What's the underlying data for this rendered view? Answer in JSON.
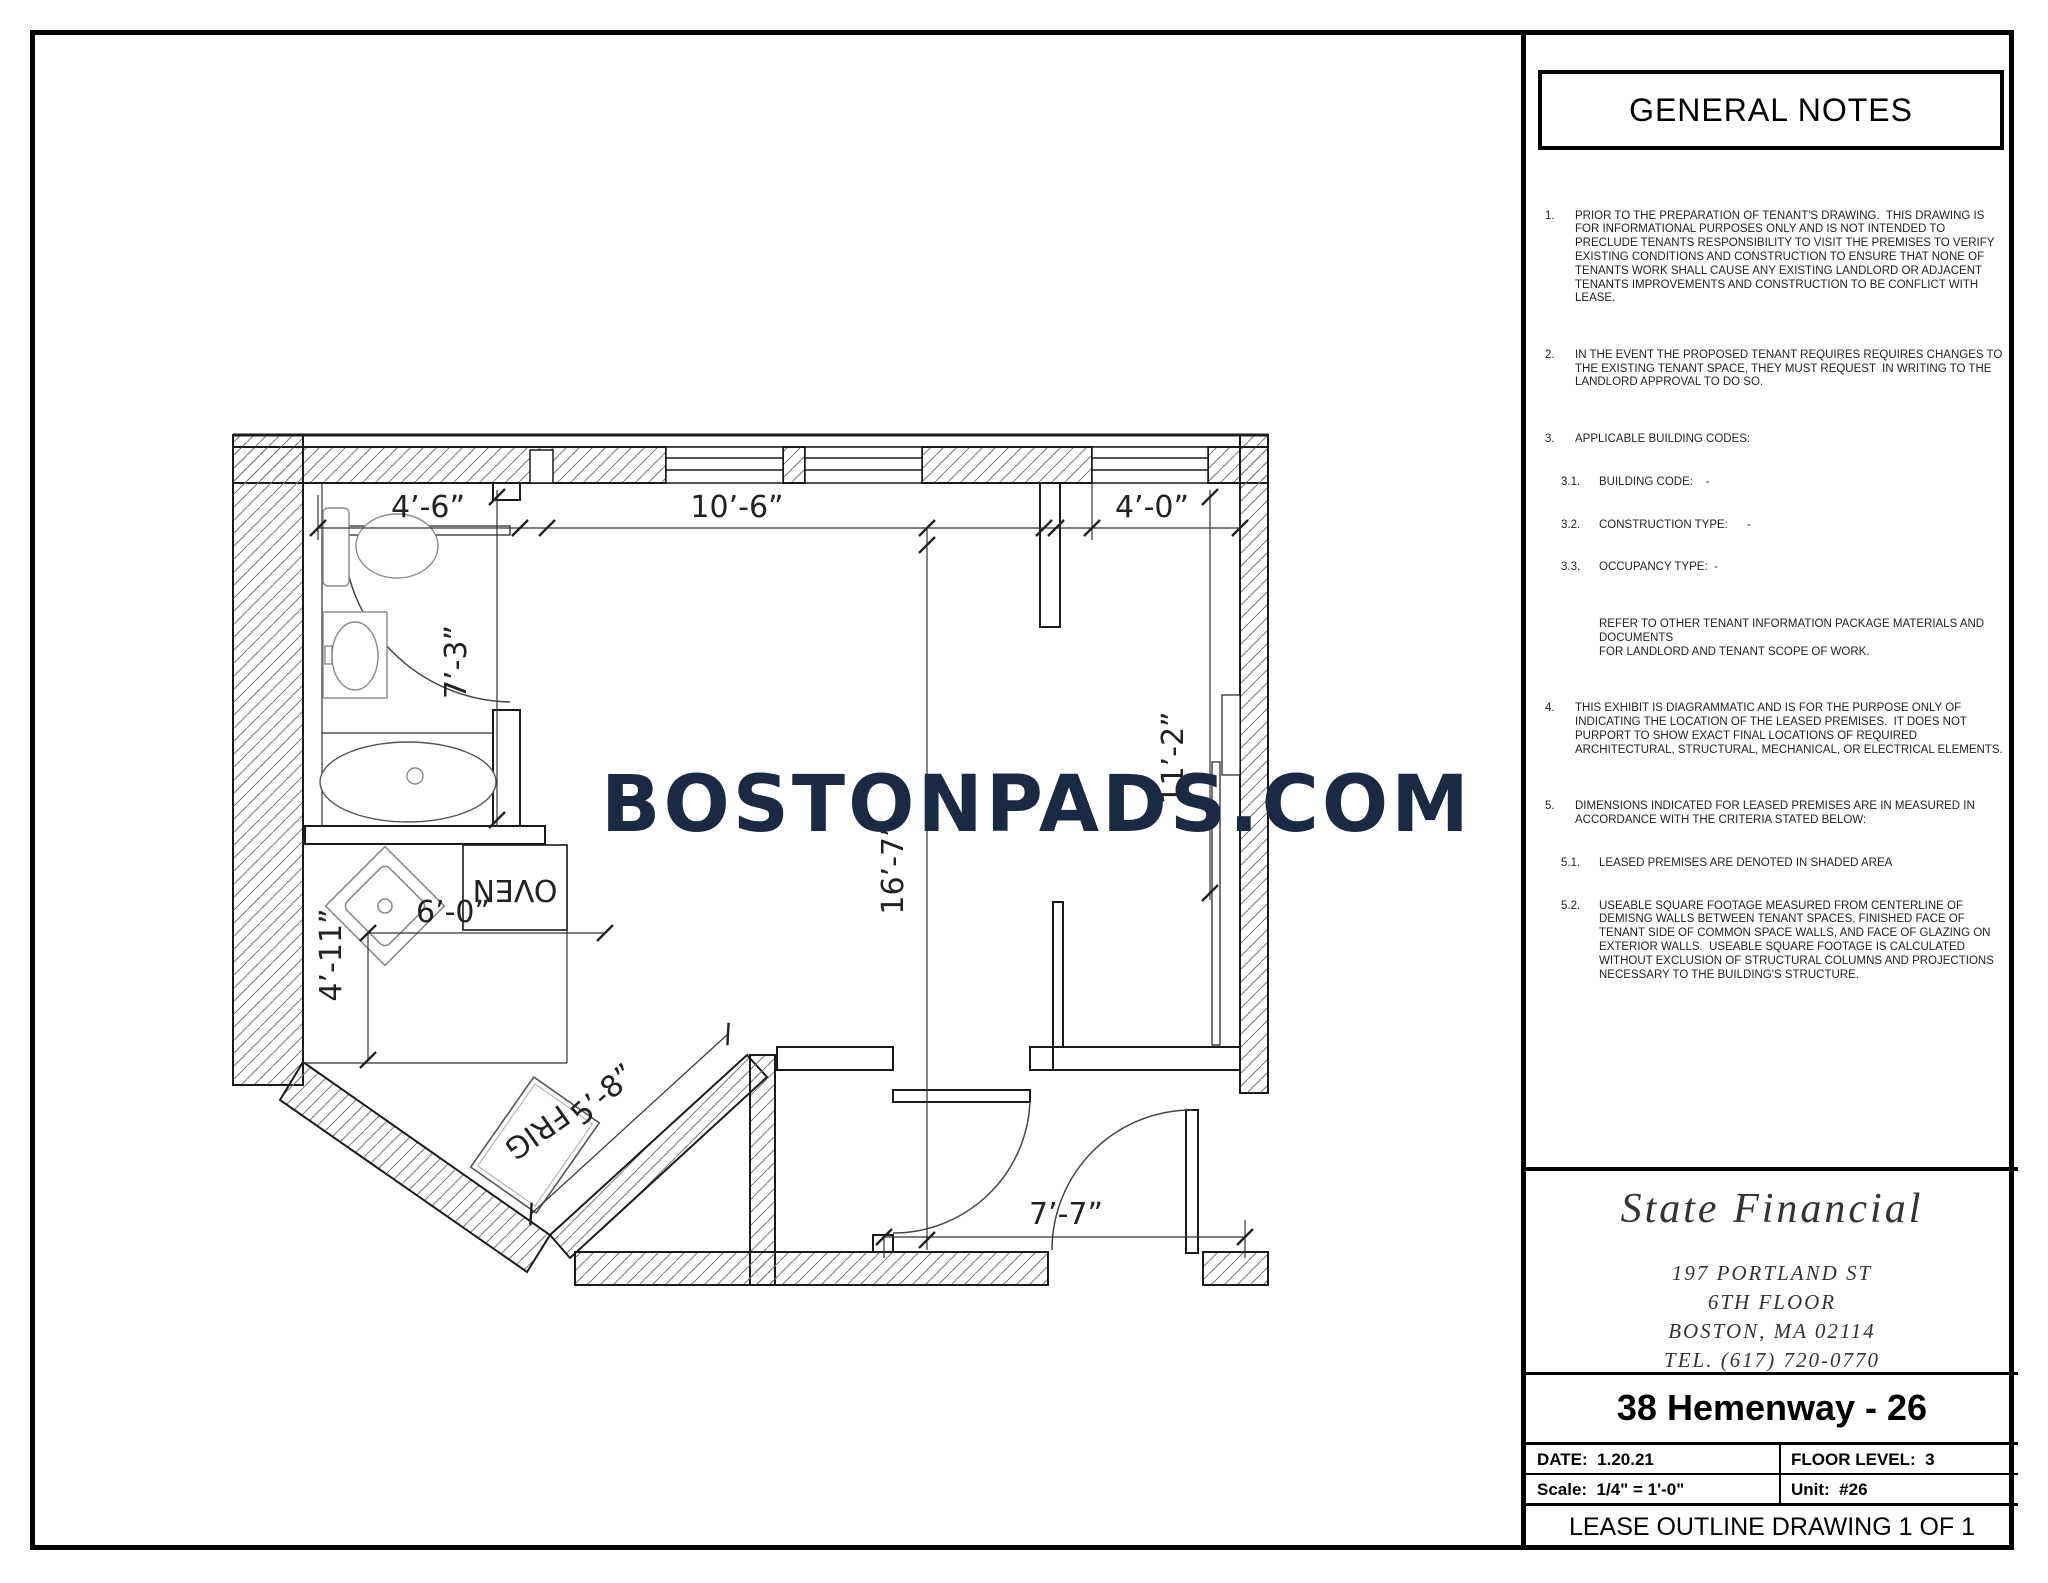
{
  "watermark": "BOSTONPADS.COM",
  "plan": {
    "dims": {
      "top_left": "4’-6”",
      "top_mid": "10’-6”",
      "top_right": "4’-0”",
      "bath_height": "7’-3”",
      "room_height": "16’-7”",
      "closet_height": "11’-2”",
      "kitchen_height": "4’-11”",
      "kitchen_width": "6’-0”",
      "bay_wall": "5’-8”",
      "entry": "7’-7”"
    },
    "labels": {
      "oven": "OVEN",
      "frig": "FRIG"
    }
  },
  "notes": {
    "title": "GENERAL NOTES",
    "items": [
      {
        "num": "1.",
        "text": "PRIOR TO THE PREPARATION OF TENANT'S DRAWING.  THIS DRAWING IS FOR INFORMATIONAL PURPOSES ONLY AND IS NOT INTENDED TO PRECLUDE TENANTS RESPONSIBILITY TO VISIT THE PREMISES TO VERIFY EXISTING CONDITIONS AND CONSTRUCTION TO ENSURE THAT NONE OF TENANTS WORK SHALL CAUSE ANY EXISTING LANDLORD OR ADJACENT TENANTS IMPROVEMENTS AND CONSTRUCTION TO BE CONFLICT WITH LEASE."
      },
      {
        "num": "2.",
        "text": "IN THE EVENT THE PROPOSED TENANT REQUIRES REQUIRES CHANGES TO THE EXISTING TENANT SPACE, THEY MUST REQUEST  IN WRITING TO THE LANDLORD APPROVAL TO DO SO."
      },
      {
        "num": "3.",
        "text": "APPLICABLE BUILDING CODES:"
      },
      {
        "num": "4.",
        "text": "THIS EXHIBIT IS DIAGRAMMATIC AND IS FOR THE PURPOSE ONLY OF INDICATING THE LOCATION OF THE LEASED PREMISES.  IT DOES NOT PURPORT TO SHOW EXACT FINAL LOCATIONS OF REQUIRED ARCHITECTURAL, STRUCTURAL, MECHANICAL, OR ELECTRICAL ELEMENTS."
      },
      {
        "num": "5.",
        "text": "DIMENSIONS INDICATED FOR LEASED PREMISES ARE IN MEASURED IN ACCORDANCE WITH THE CRITERIA STATED BELOW:"
      }
    ],
    "sub3": [
      {
        "num": "3.1.",
        "text": "BUILDING CODE:    -"
      },
      {
        "num": "3.2.",
        "text": "CONSTRUCTION TYPE:      -"
      },
      {
        "num": "3.3.",
        "text": "OCCUPANCY TYPE:  -"
      }
    ],
    "refer": "REFER TO OTHER TENANT INFORMATION PACKAGE MATERIALS AND DOCUMENTS\nFOR LANDLORD AND TENANT SCOPE OF WORK.",
    "sub5": [
      {
        "num": "5.1.",
        "text": "LEASED PREMISES ARE DENOTED IN SHADED AREA"
      },
      {
        "num": "5.2.",
        "text": "USEABLE SQUARE FOOTAGE MEASURED FROM CENTERLINE OF DEMISNG WALLS BETWEEN TENANT SPACES, FINISHED FACE OF TENANT SIDE OF COMMON SPACE WALLS, AND FACE OF GLAZING ON EXTERIOR WALLS.  USEABLE SQUARE FOOTAGE IS CALCULATED WITHOUT EXCLUSION OF STRUCTURAL COLUMNS AND PROJECTIONS NECESSARY TO THE BUILDING'S STRUCTURE."
      }
    ]
  },
  "firm": {
    "name": "State Financial",
    "address1": "197 PORTLAND ST",
    "address2": "6TH FLOOR",
    "address3": "BOSTON, MA 02114",
    "tel": "TEL. (617) 720-0770"
  },
  "titleblock": {
    "project": "38 Hemenway - 26",
    "date_label": "DATE:",
    "date_value": "1.20.21",
    "floor_label": "FLOOR LEVEL:",
    "floor_value": "3",
    "scale_label": "Scale:",
    "scale_value": "1/4\" = 1'-0\"",
    "unit_label": "Unit:",
    "unit_value": "#26",
    "sheet_title": "LEASE OUTLINE DRAWING 1 OF 1"
  }
}
